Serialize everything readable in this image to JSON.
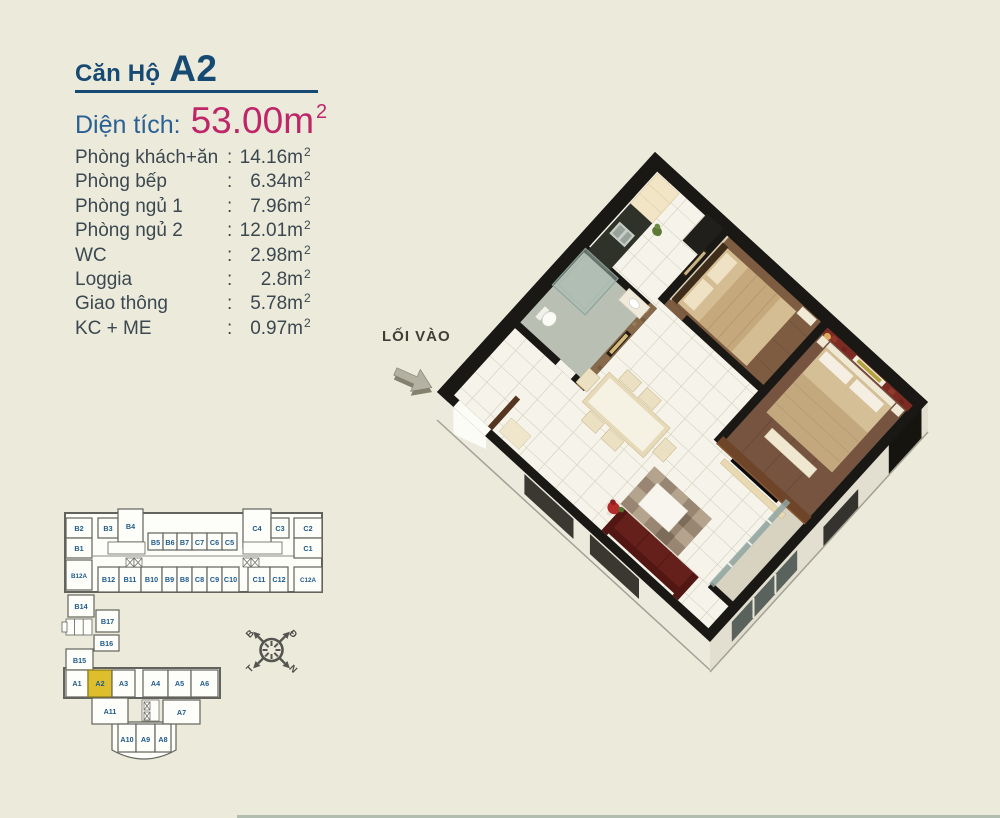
{
  "page": {
    "background": "#ecebdb",
    "accent_navy": "#174a73",
    "accent_blue": "#2b6094",
    "accent_magenta": "#bf2569",
    "highlight_yellow": "#ddbf2e"
  },
  "header": {
    "title_prefix": "Căn Hộ",
    "unit_code": "A2"
  },
  "area": {
    "label": "Diện tích:",
    "value": "53.00m"
  },
  "common": {
    "colon": ":",
    "sup": "2"
  },
  "rooms": [
    {
      "label": "Phòng khách+ăn",
      "value": "14.16m"
    },
    {
      "label": "Phòng bếp",
      "value": "6.34m"
    },
    {
      "label": "Phòng ngủ 1",
      "value": "7.96m"
    },
    {
      "label": "Phòng ngủ 2",
      "value": "12.01m"
    },
    {
      "label": "WC",
      "value": "2.98m"
    },
    {
      "label": "Loggia",
      "value": "2.8m"
    },
    {
      "label": "Giao thông",
      "value": "5.78m"
    },
    {
      "label": "KC + ME",
      "value": "0.97m"
    }
  ],
  "floorplan": {
    "entrance_label": "LỐI VÀO"
  },
  "compass": {
    "top_left": "B",
    "top_right": "Đ",
    "bottom_left": "T",
    "bottom_right": "N"
  },
  "keyplan": {
    "highlight": "A2",
    "units": [
      "B2",
      "B3",
      "B4",
      "B5",
      "B6",
      "B7",
      "C7",
      "C6",
      "C5",
      "C4",
      "C3",
      "C2",
      "B1",
      "C1",
      "B12A",
      "B12",
      "B11",
      "B10",
      "B9",
      "B8",
      "C8",
      "C9",
      "C10",
      "C11",
      "C12",
      "C12A",
      "B14",
      "B17",
      "B16",
      "B15",
      "A1",
      "A2",
      "A3",
      "A4",
      "A5",
      "A6",
      "A11",
      "A7",
      "A10",
      "A9",
      "A8"
    ]
  }
}
